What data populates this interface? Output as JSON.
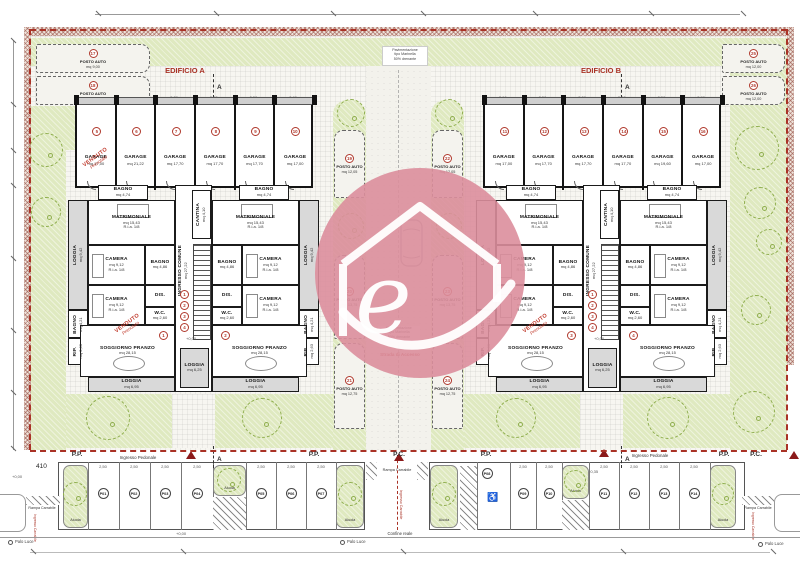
{
  "colors": {
    "accent_red": "#a93226",
    "green": "#dfe9c0",
    "logo_pink": "#dc8e9c",
    "wall": "#1b1b1b"
  },
  "titles": {
    "edificio_a": "EDIFICIO A",
    "edificio_b": "EDIFICIO B"
  },
  "logo": {
    "letter": "e"
  },
  "notes": {
    "paving_l1": "Pavimentazione",
    "paving_l2": "tipo Marinella",
    "paving_l3": "50% drenante",
    "strada": "Strada di Accesso",
    "ingresso_pedonale": "Ingresso Pedonale",
    "ingresso_carrabile": "Ingresso Carrabile",
    "rampa_carrabile": "Rampa Carrabile",
    "confine": "Confine reale",
    "palo_luce": "Palo Luce",
    "aiuola": "Aiuola",
    "dim_410": "410",
    "level_zero": "+0,00",
    "level_plus": "+0,35",
    "section": "A",
    "pp": "P.P.",
    "pc": "P.C.",
    "disabled_icon": "♿"
  },
  "stamp": {
    "line1": "VENDUTO",
    "line2": "Prenotato"
  },
  "posto_auto_label": "POSTO AUTO",
  "buildings": [
    {
      "id": "A",
      "garages": [
        {
          "badge": "5",
          "name": "GARAGE",
          "mq": "mq 17,00",
          "sold": true
        },
        {
          "badge": "6",
          "name": "GARAGE",
          "mq": "mq 21,22",
          "sold": false
        },
        {
          "badge": "7",
          "name": "GARAGE",
          "mq": "mq 17,70",
          "sold": false
        },
        {
          "badge": "8",
          "name": "GARAGE",
          "mq": "mq 17,70",
          "sold": false
        },
        {
          "badge": "9",
          "name": "GARAGE",
          "mq": "mq 17,70",
          "sold": false
        },
        {
          "badge": "10",
          "name": "GARAGE",
          "mq": "mq 17,00",
          "sold": false
        }
      ],
      "garage_dims": [
        "2,90",
        "3,50",
        "3,50",
        "3,50",
        "3,50",
        "2,90"
      ],
      "units": [
        {
          "badge": "1",
          "sold": true
        },
        {
          "badge": "2",
          "sold": false
        }
      ],
      "core": {
        "ingresso": "INGRESSO COMUNE",
        "ingresso_mq": "mq 27,22",
        "cantina": "CANTINA",
        "cantina_mq": "mq 4,10",
        "loggia": "LOGGIA",
        "loggia_mq": "mq 6,25",
        "badges": [
          "1",
          "2",
          "3",
          "4"
        ],
        "level": "+0,00"
      }
    },
    {
      "id": "B",
      "garages": [
        {
          "badge": "11",
          "name": "GARAGE",
          "mq": "mq 17,00",
          "sold": false
        },
        {
          "badge": "12",
          "name": "GARAGE",
          "mq": "mq 17,70",
          "sold": false
        },
        {
          "badge": "13",
          "name": "GARAGE",
          "mq": "mq 17,70",
          "sold": false
        },
        {
          "badge": "14",
          "name": "GARAGE",
          "mq": "mq 17,70",
          "sold": false
        },
        {
          "badge": "15",
          "name": "GARAGE",
          "mq": "mq 19,60",
          "sold": false
        },
        {
          "badge": "16",
          "name": "GARAGE",
          "mq": "mq 17,00",
          "sold": false
        }
      ],
      "garage_dims": [
        "2,90",
        "3,50",
        "3,50",
        "3,50",
        "3,50",
        "2,90"
      ],
      "units": [
        {
          "badge": "3",
          "sold": true
        },
        {
          "badge": "4",
          "sold": false
        }
      ],
      "core": {
        "ingresso": "INGRESSO COMUNE",
        "ingresso_mq": "mq 27,22",
        "cantina": "CANTINA",
        "cantina_mq": "mq 4,10",
        "loggia": "LOGGIA",
        "loggia_mq": "mq 6,25",
        "badges": [
          "1",
          "2",
          "3",
          "4"
        ],
        "level": "+0,00"
      }
    }
  ],
  "unit_rooms": {
    "bagno_top": {
      "name": "BAGNO",
      "mq": "mq 4,74"
    },
    "loggia_side": {
      "name": "LOGGIA",
      "mq": "mq 9,42"
    },
    "matrimoniale": {
      "name": "MATRIMONIALE",
      "mq": "mq 15,43",
      "ratio": "R.i.a. 1/8"
    },
    "camera1": {
      "name": "CAMERA",
      "mq": "mq 9,12",
      "ratio": "R.i.a. 1/8"
    },
    "bagno": {
      "name": "BAGNO",
      "mq": "mq 4,86"
    },
    "camera2": {
      "name": "CAMERA",
      "mq": "mq 9,12",
      "ratio": "R.i.a. 1/8"
    },
    "dis": {
      "name": "DIS."
    },
    "wc": {
      "name": "W.C.",
      "mq": "mq 2,60"
    },
    "bagno2": {
      "name": "BAGNO",
      "mq": "mq 4,21"
    },
    "rip": {
      "name": "RIP.",
      "mq": "mq 2,63"
    },
    "soggiorno": {
      "name": "SOGGIORNO PRANZO",
      "mq": "mq 28,15"
    },
    "loggia_bottom": {
      "name": "LOGGIA",
      "mq": "mq 6,95"
    }
  },
  "posti_auto": {
    "top_left": [
      {
        "badge": "17",
        "mq": "mq 9,00"
      },
      {
        "badge": "18",
        "mq": "mq 9,00"
      }
    ],
    "top_right": [
      {
        "badge": "25",
        "mq": "mq 12,00"
      },
      {
        "badge": "26",
        "mq": "mq 12,00"
      }
    ],
    "central": [
      {
        "badge": "19",
        "mq": "mq 12,05"
      },
      {
        "badge": "22",
        "mq": "mq 12,05"
      },
      {
        "badge": "20",
        "mq": "mq 13,75"
      },
      {
        "badge": "23",
        "mq": "mq 13,75"
      },
      {
        "badge": "21",
        "mq": "mq 12,75"
      },
      {
        "badge": "24",
        "mq": "mq 12,75"
      }
    ]
  },
  "parking": {
    "stall_dim": "2,50",
    "left": [
      "P01",
      "P02",
      "P03",
      "P04",
      "P05",
      "P06",
      "P07"
    ],
    "right": [
      "P08",
      "P09",
      "P10",
      "P11",
      "P12",
      "P13",
      "P14"
    ]
  }
}
